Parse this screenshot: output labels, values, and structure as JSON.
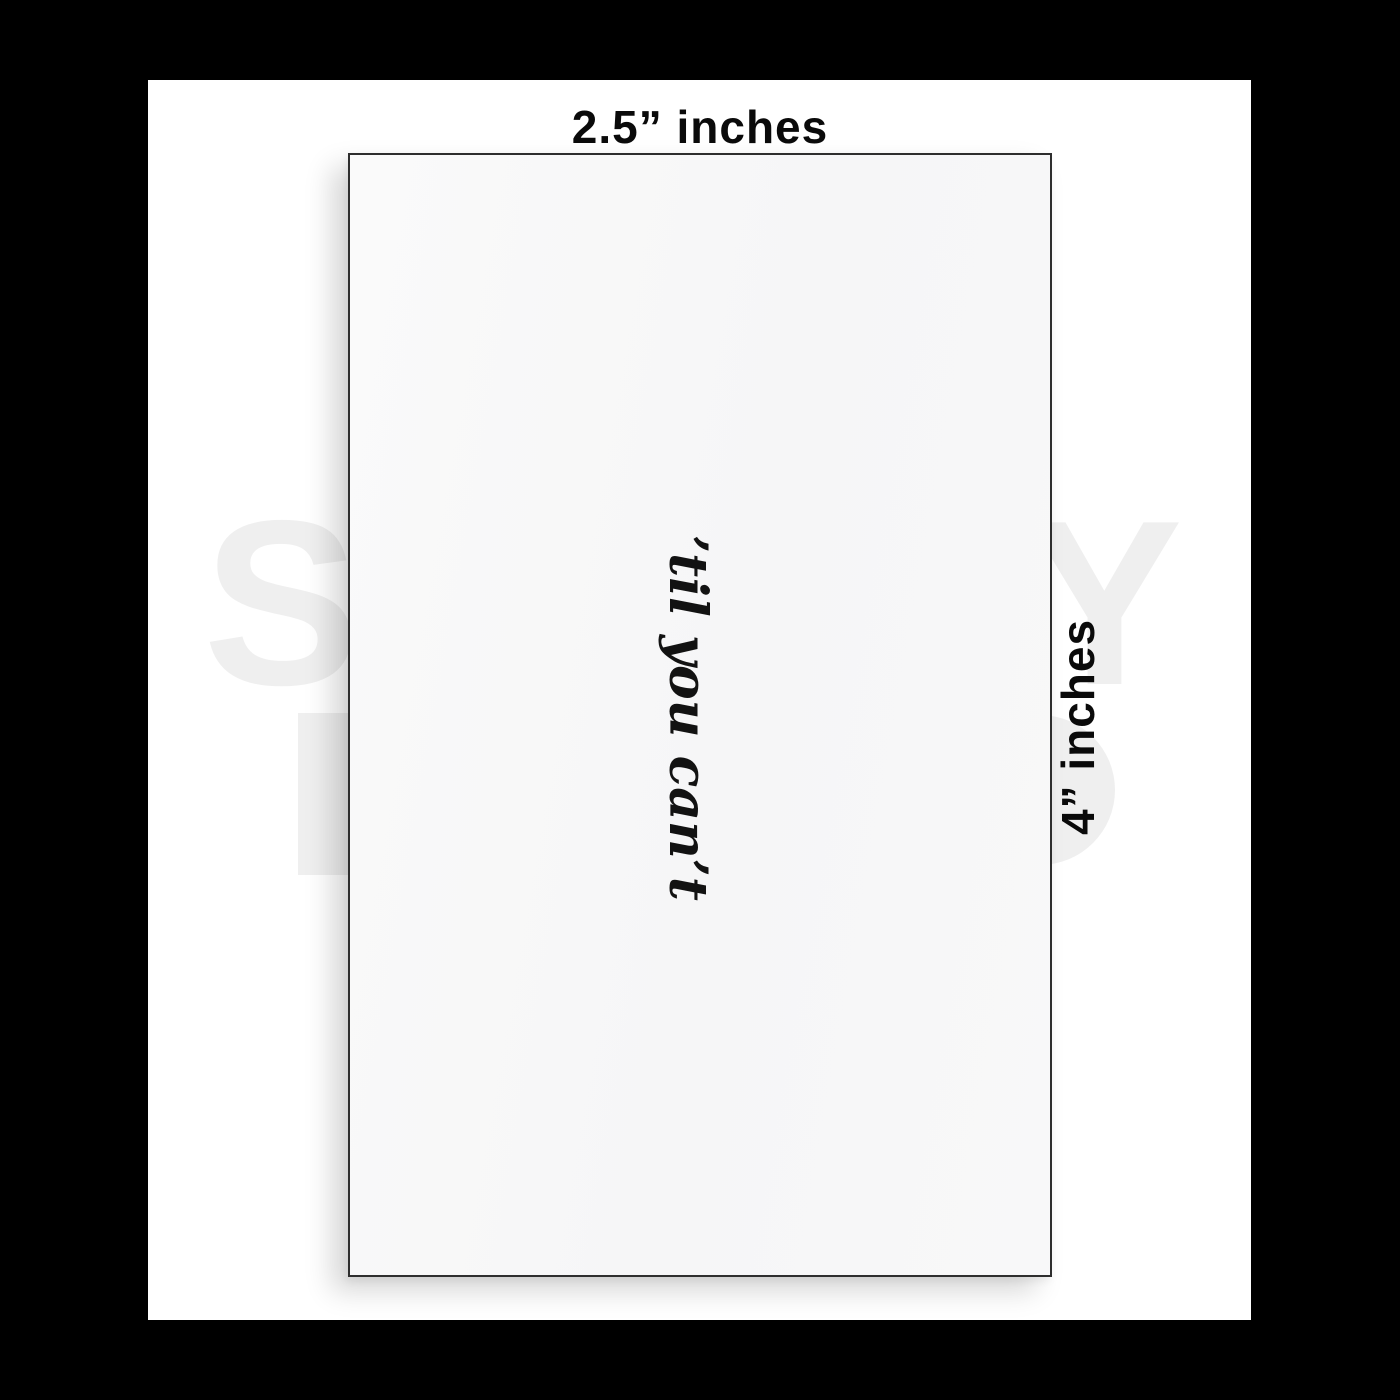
{
  "mockup": {
    "width_label": "2.5” inches",
    "height_label": "4” inches",
    "sticker_text": "’til you can’t"
  },
  "watermark": {
    "letter_left": "S",
    "letter_right": "Y",
    "color": "#efefef"
  },
  "colors": {
    "frame_background": "#000000",
    "stage_background": "#ffffff",
    "card_fill": "#f7f7f8",
    "card_border": "#2e2e2e",
    "label_text": "#0a0a0a",
    "quote_text": "#121212"
  }
}
